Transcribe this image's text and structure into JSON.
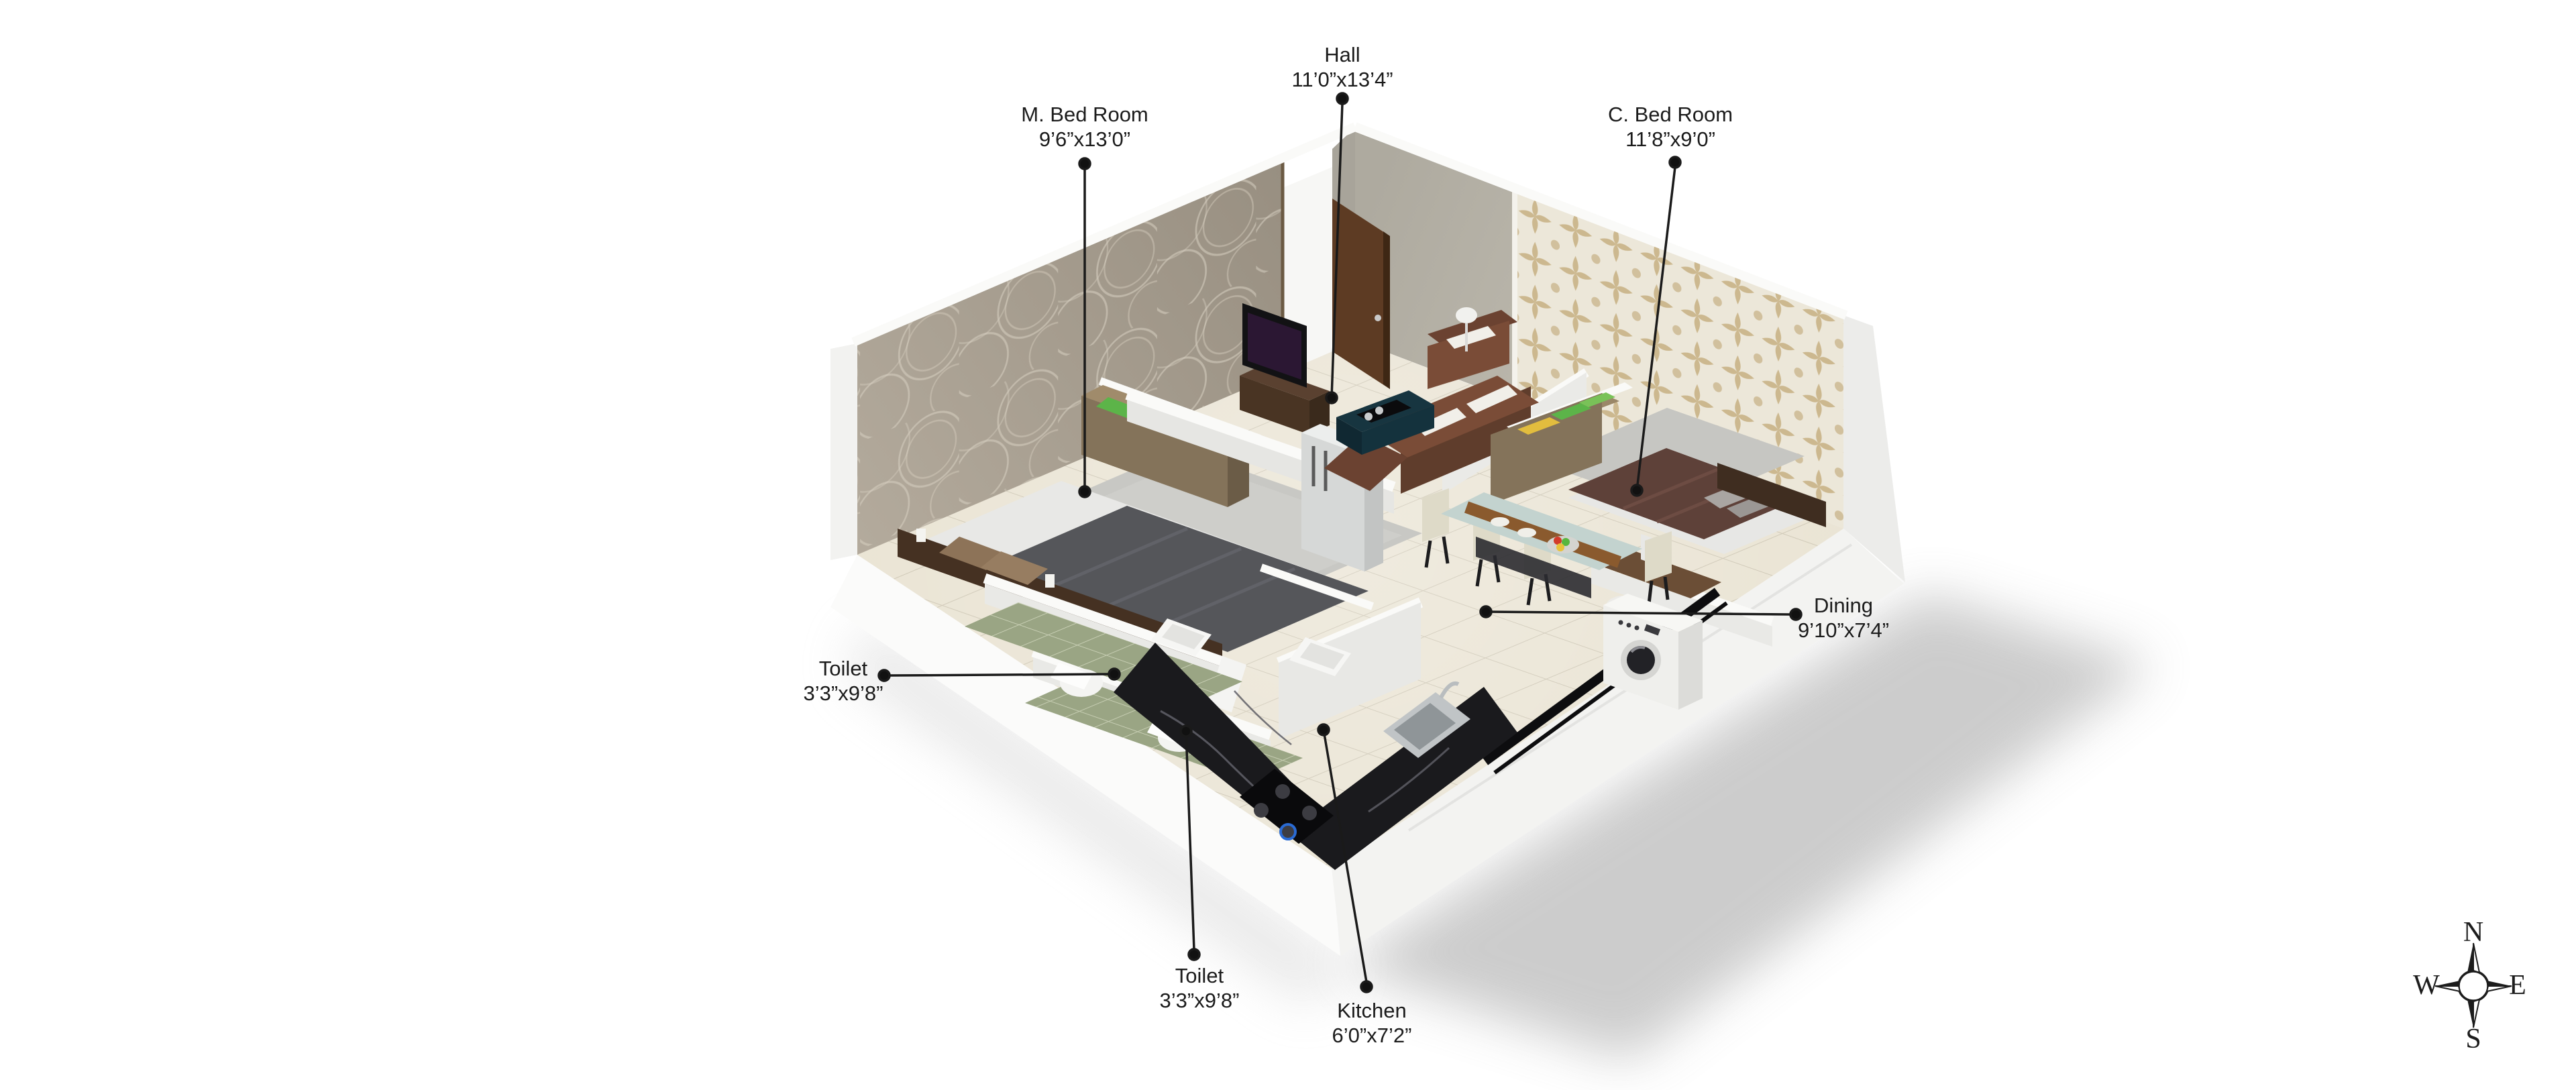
{
  "document": {
    "type": "3d-isometric-floor-plan",
    "background": "#ffffff"
  },
  "rooms": [
    {
      "id": "m-bed-room",
      "name": "M. Bed Room",
      "dims": "9’6”x13’0”"
    },
    {
      "id": "hall",
      "name": "Hall",
      "dims": "11’0”x13’4”"
    },
    {
      "id": "c-bed-room",
      "name": "C. Bed Room",
      "dims": "11’8”x9’0”"
    },
    {
      "id": "dining",
      "name": "Dining",
      "dims": "9’10”x7’4”"
    },
    {
      "id": "toilet-left",
      "name": "Toilet",
      "dims": "3’3”x9’8”"
    },
    {
      "id": "toilet-bottom",
      "name": "Toilet",
      "dims": "3’3”x9’8”"
    },
    {
      "id": "kitchen",
      "name": "Kitchen",
      "dims": "6’0”x7’2”"
    }
  ],
  "compass": {
    "north": "N",
    "east": "E",
    "south": "S",
    "west": "W"
  },
  "palette": {
    "label_text": "#1b1b1b",
    "leader_line": "#1a1a1a",
    "wall_taupe": "#a49b8d",
    "wall_plain": "#b5b1a6",
    "wallpaper_damask_motif": "#c7b083",
    "floor_tile": "#eae4d4",
    "toilet_floor_green": "#9aa584",
    "kitchen_counter_black": "#1a1a1d",
    "wood_furniture": "#84735a",
    "sofa_brown": "#7a4c37",
    "bed_gray": "#55565a",
    "bed_plum": "#5e4139",
    "towel_green": "#5cb449",
    "towel_yellow": "#e2bd3e",
    "shell_white": "#fbfbfa"
  }
}
